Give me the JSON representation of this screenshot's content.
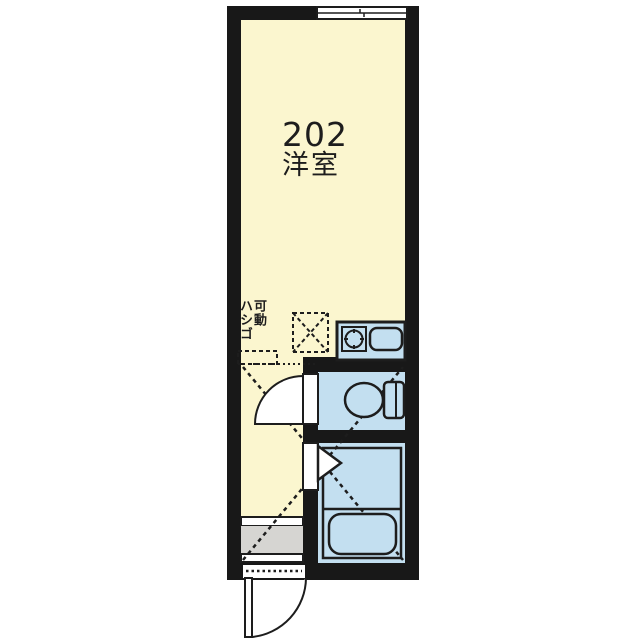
{
  "room": {
    "number": "202",
    "type_label": "洋室"
  },
  "loft_ladder": {
    "line1": "可動",
    "line2": "ハシゴ"
  },
  "colors": {
    "bg": "#ffffff",
    "ink": "#1d1d1d",
    "wall": "#181818",
    "room_fill": "#FBF6CF",
    "wet_fill": "#C3DFF0",
    "entry_fill": "#D6D5D2",
    "white": "#ffffff"
  },
  "fixtures": {
    "window": "sliding-window",
    "kitchen_stove": "single-burner-stove",
    "kitchen_sink": "sink",
    "toilet": "toilet",
    "bathtub": "bathtub",
    "toilet_door": "hinged-door",
    "bathroom_door": "folding-door",
    "entrance_door": "hinged-door",
    "loft_marking": "dashed-loft-area"
  }
}
